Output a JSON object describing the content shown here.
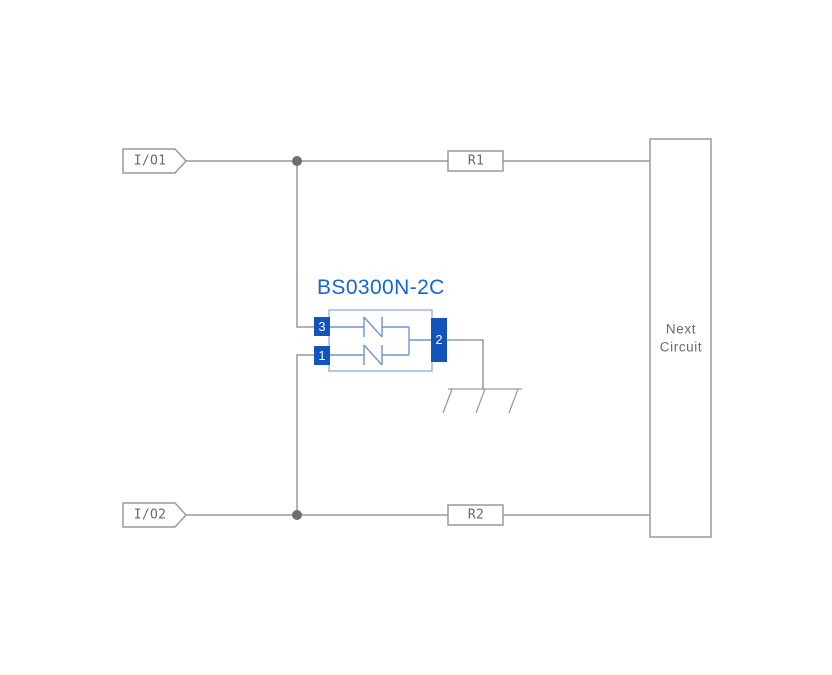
{
  "diagram": {
    "component": {
      "name": "BS0300N-2C",
      "pin_top_left": "3",
      "pin_bottom_left": "1",
      "pin_right": "2"
    },
    "ports": {
      "io1": "I/O1",
      "io2": "I/O2"
    },
    "resistors": {
      "r1": "R1",
      "r2": "R2"
    },
    "next_circuit": {
      "line1": "Next",
      "line2": "Circuit"
    },
    "colors": {
      "accent_blue": "#1565d4",
      "pin_blue": "#1254bc",
      "body_border_blue": "#9db8e0",
      "diode_blue": "#6f95cf",
      "wire_grey": "#9a9a9a",
      "junction_grey": "#6e6e6e",
      "label_grey": "#6a6a6a"
    }
  }
}
